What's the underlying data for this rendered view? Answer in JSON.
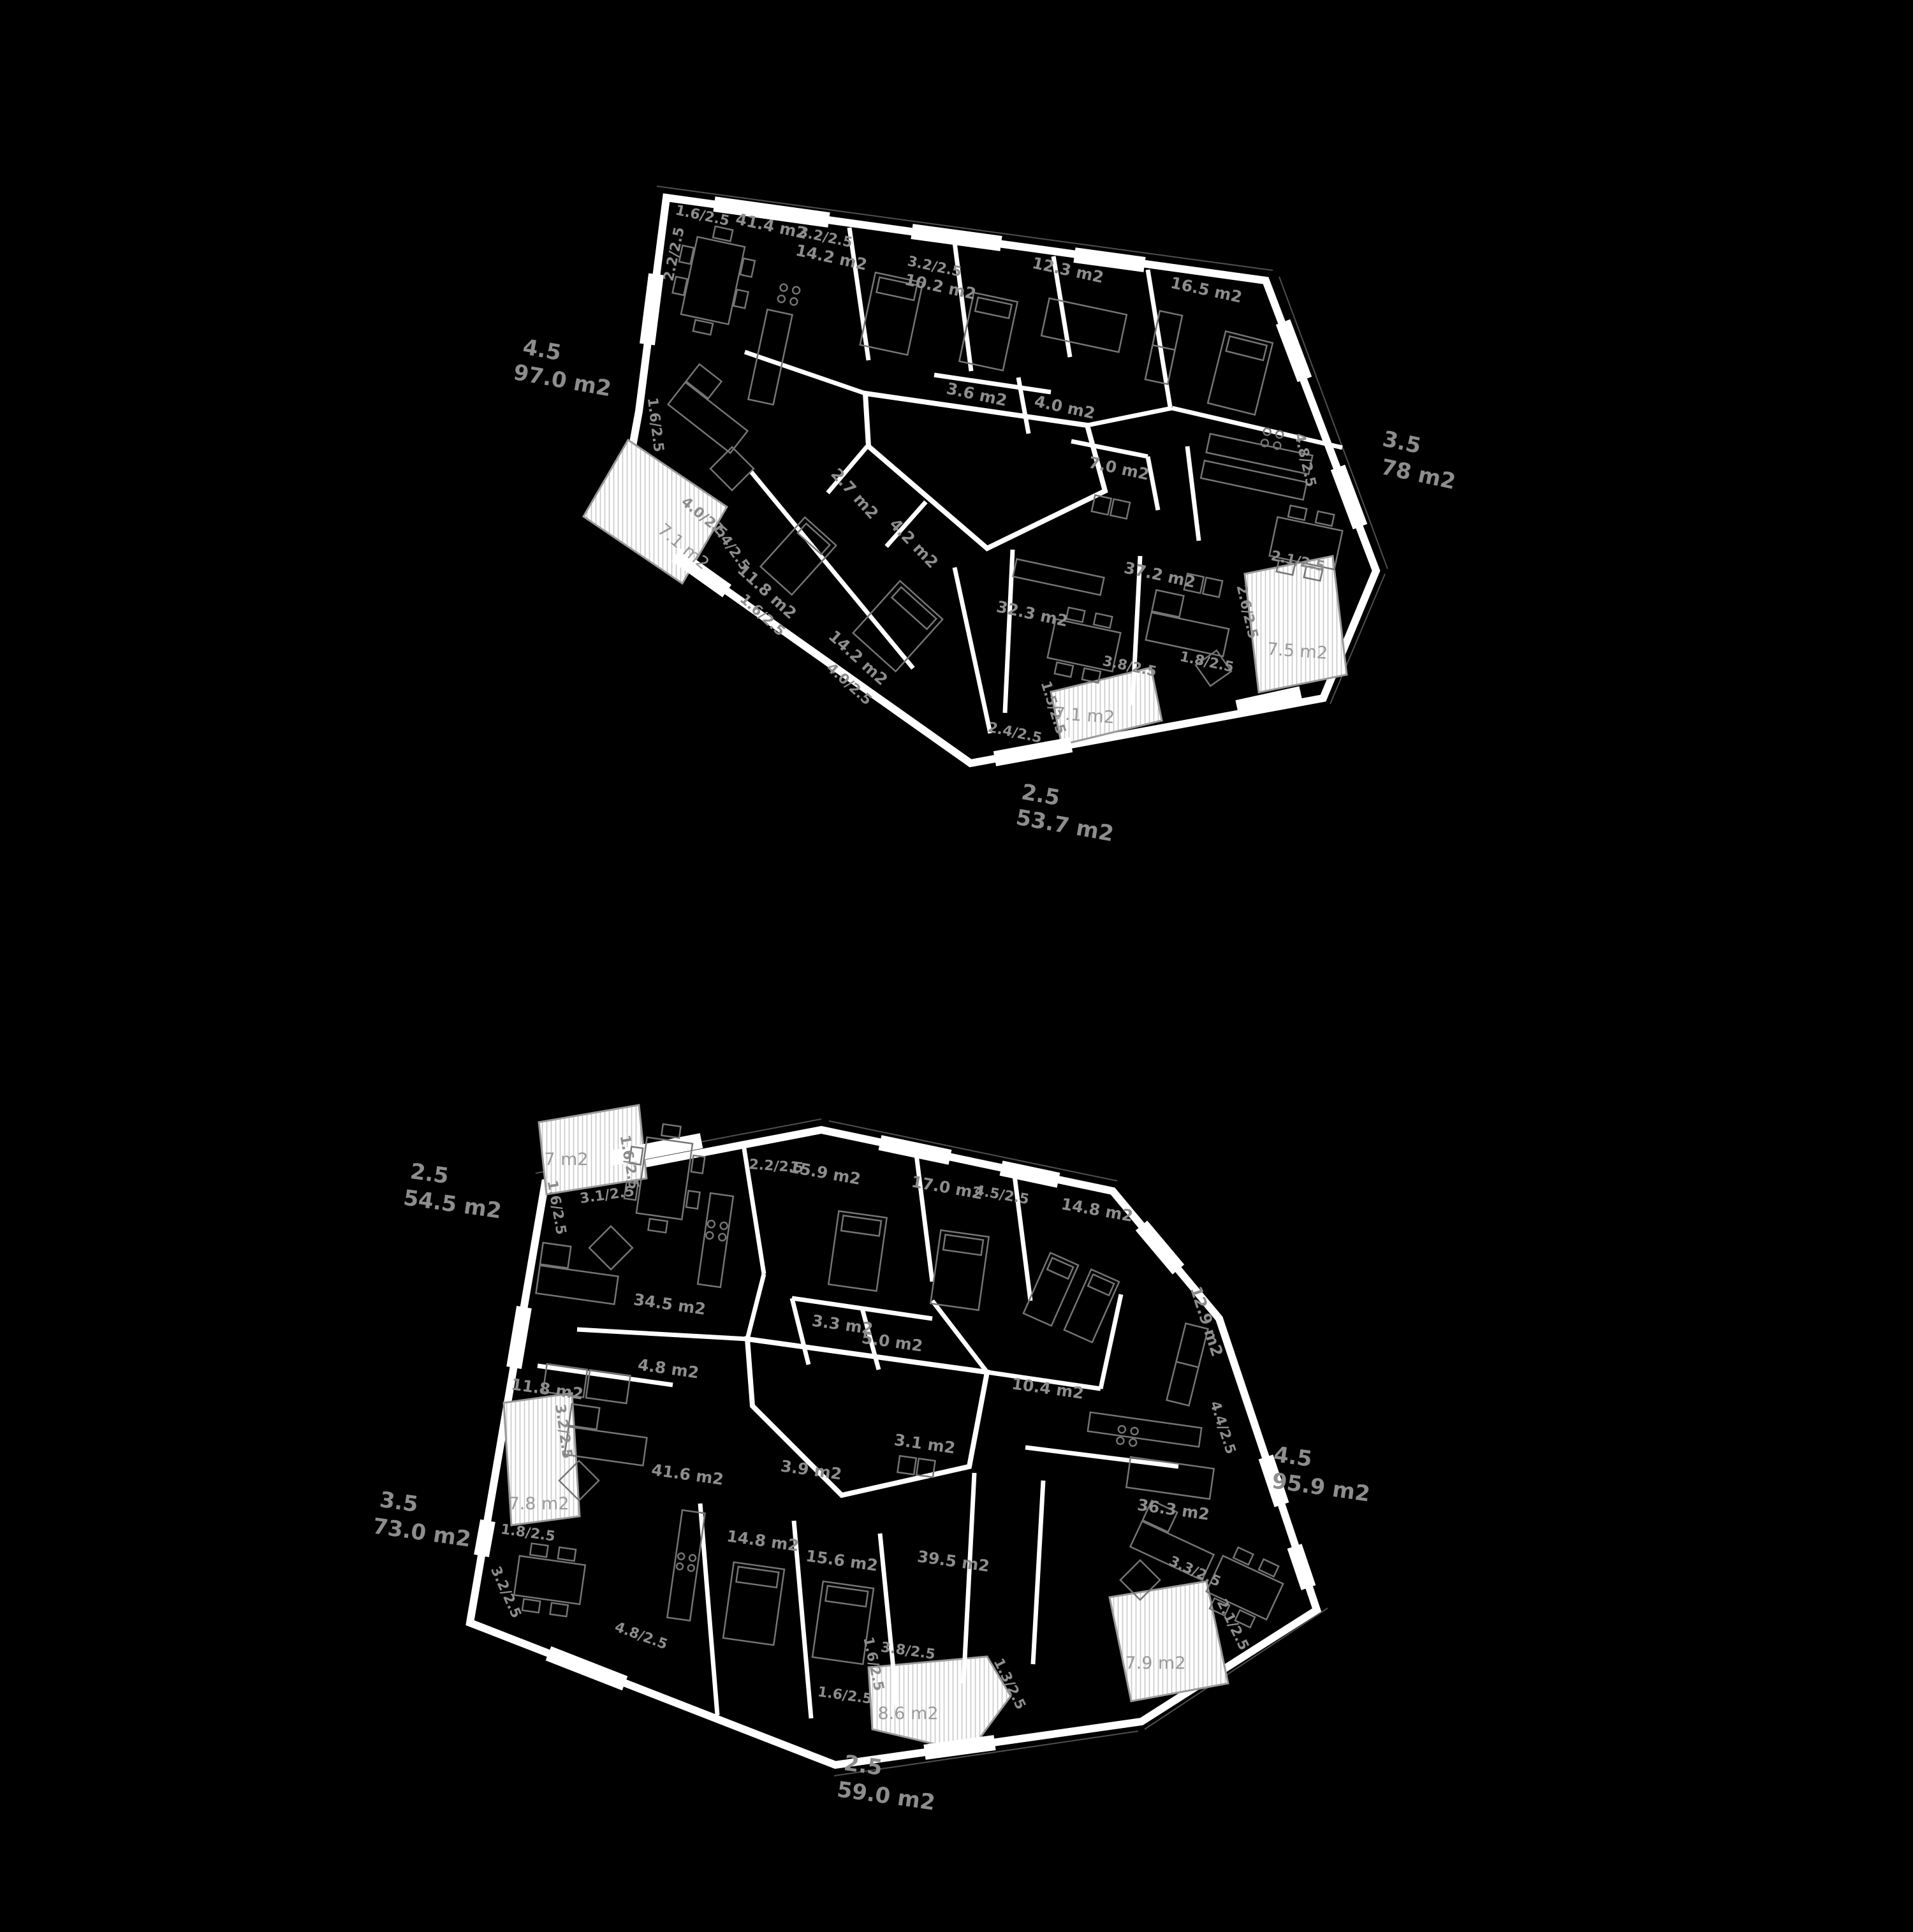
{
  "palette": {
    "background": "#000000",
    "walls": "#ffffff",
    "label_gray": "#8d8d8d",
    "balcony_label_gray": "#9a9a9a",
    "furniture_gray": "#757575"
  },
  "plans": {
    "upper": {
      "summaries": [
        {
          "value": "4.5",
          "area": "97.0 m2"
        },
        {
          "value": "3.5",
          "area": "78 m2"
        },
        {
          "value": "2.5",
          "area": "53.7 m2"
        }
      ],
      "labels": [
        {
          "t": "1.6/2.5"
        },
        {
          "t": "41.4 m2"
        },
        {
          "t": "2.2/2.5"
        },
        {
          "t": "3.2/2.5"
        },
        {
          "t": "14.2 m2"
        },
        {
          "t": "3.2/2.5"
        },
        {
          "t": "10.2 m2"
        },
        {
          "t": "12.3 m2"
        },
        {
          "t": "16.5 m2"
        },
        {
          "t": "3.6 m2"
        },
        {
          "t": "4.0 m2"
        },
        {
          "t": "7.0 m2"
        },
        {
          "t": "2.7 m2"
        },
        {
          "t": "4.2 m2"
        },
        {
          "t": "11.8 m2"
        },
        {
          "t": "1.6/2.5"
        },
        {
          "t": "14.2 m2"
        },
        {
          "t": "4.0/2.5"
        },
        {
          "t": "32.3 m2"
        },
        {
          "t": "37.2 m2"
        },
        {
          "t": "4.8/2.5"
        },
        {
          "t": "2.1/2.5"
        },
        {
          "t": "2.6/2.5"
        },
        {
          "t": "1.8/2.5"
        },
        {
          "t": "7.5 m2"
        },
        {
          "t": "3.8/2.5"
        },
        {
          "t": "1.5/2.5"
        },
        {
          "t": "7.1 m2"
        },
        {
          "t": "2.4/2.5"
        },
        {
          "t": "1.6/2.5"
        },
        {
          "t": "4.0/2.5"
        },
        {
          "t": "7.1 m2"
        },
        {
          "t": "1.4/2.5"
        }
      ]
    },
    "lower": {
      "summaries": [
        {
          "value": "2.5",
          "area": "54.5 m2"
        },
        {
          "value": "3.5",
          "area": "73.0 m2"
        },
        {
          "value": "4.5",
          "area": "95.9 m2"
        },
        {
          "value": "2.5",
          "area": "59.0 m2"
        }
      ],
      "labels": [
        {
          "t": "7 m2"
        },
        {
          "t": "1.6/2.5"
        },
        {
          "t": "1.6/2.5"
        },
        {
          "t": "3.1/2.5"
        },
        {
          "t": "2.2/2.5"
        },
        {
          "t": "15.9 m2"
        },
        {
          "t": "17.0 m2"
        },
        {
          "t": "4.5/2.5"
        },
        {
          "t": "14.8 m2"
        },
        {
          "t": "12.9 m2"
        },
        {
          "t": "34.5 m2"
        },
        {
          "t": "4.8 m2"
        },
        {
          "t": "3.3 m2"
        },
        {
          "t": "5.0 m2"
        },
        {
          "t": "10.4 m2"
        },
        {
          "t": "4.4/2.5"
        },
        {
          "t": "3.1 m2"
        },
        {
          "t": "3.9 m2"
        },
        {
          "t": "41.6 m2"
        },
        {
          "t": "11.8 m2"
        },
        {
          "t": "3.2/2.5"
        },
        {
          "t": "7.8 m2"
        },
        {
          "t": "1.8/2.5"
        },
        {
          "t": "3.2/2.5"
        },
        {
          "t": "14.8 m2"
        },
        {
          "t": "15.6 m2"
        },
        {
          "t": "39.5 m2"
        },
        {
          "t": "36.3 m2"
        },
        {
          "t": "3.3/2.5"
        },
        {
          "t": "2.1/2.5"
        },
        {
          "t": "7.9 m2"
        },
        {
          "t": "1.3/2.5"
        },
        {
          "t": "1.6/2.5"
        },
        {
          "t": "3.8/2.5"
        },
        {
          "t": "1.6/2.5"
        },
        {
          "t": "8.6 m2"
        },
        {
          "t": "4.8/2.5"
        }
      ]
    }
  }
}
